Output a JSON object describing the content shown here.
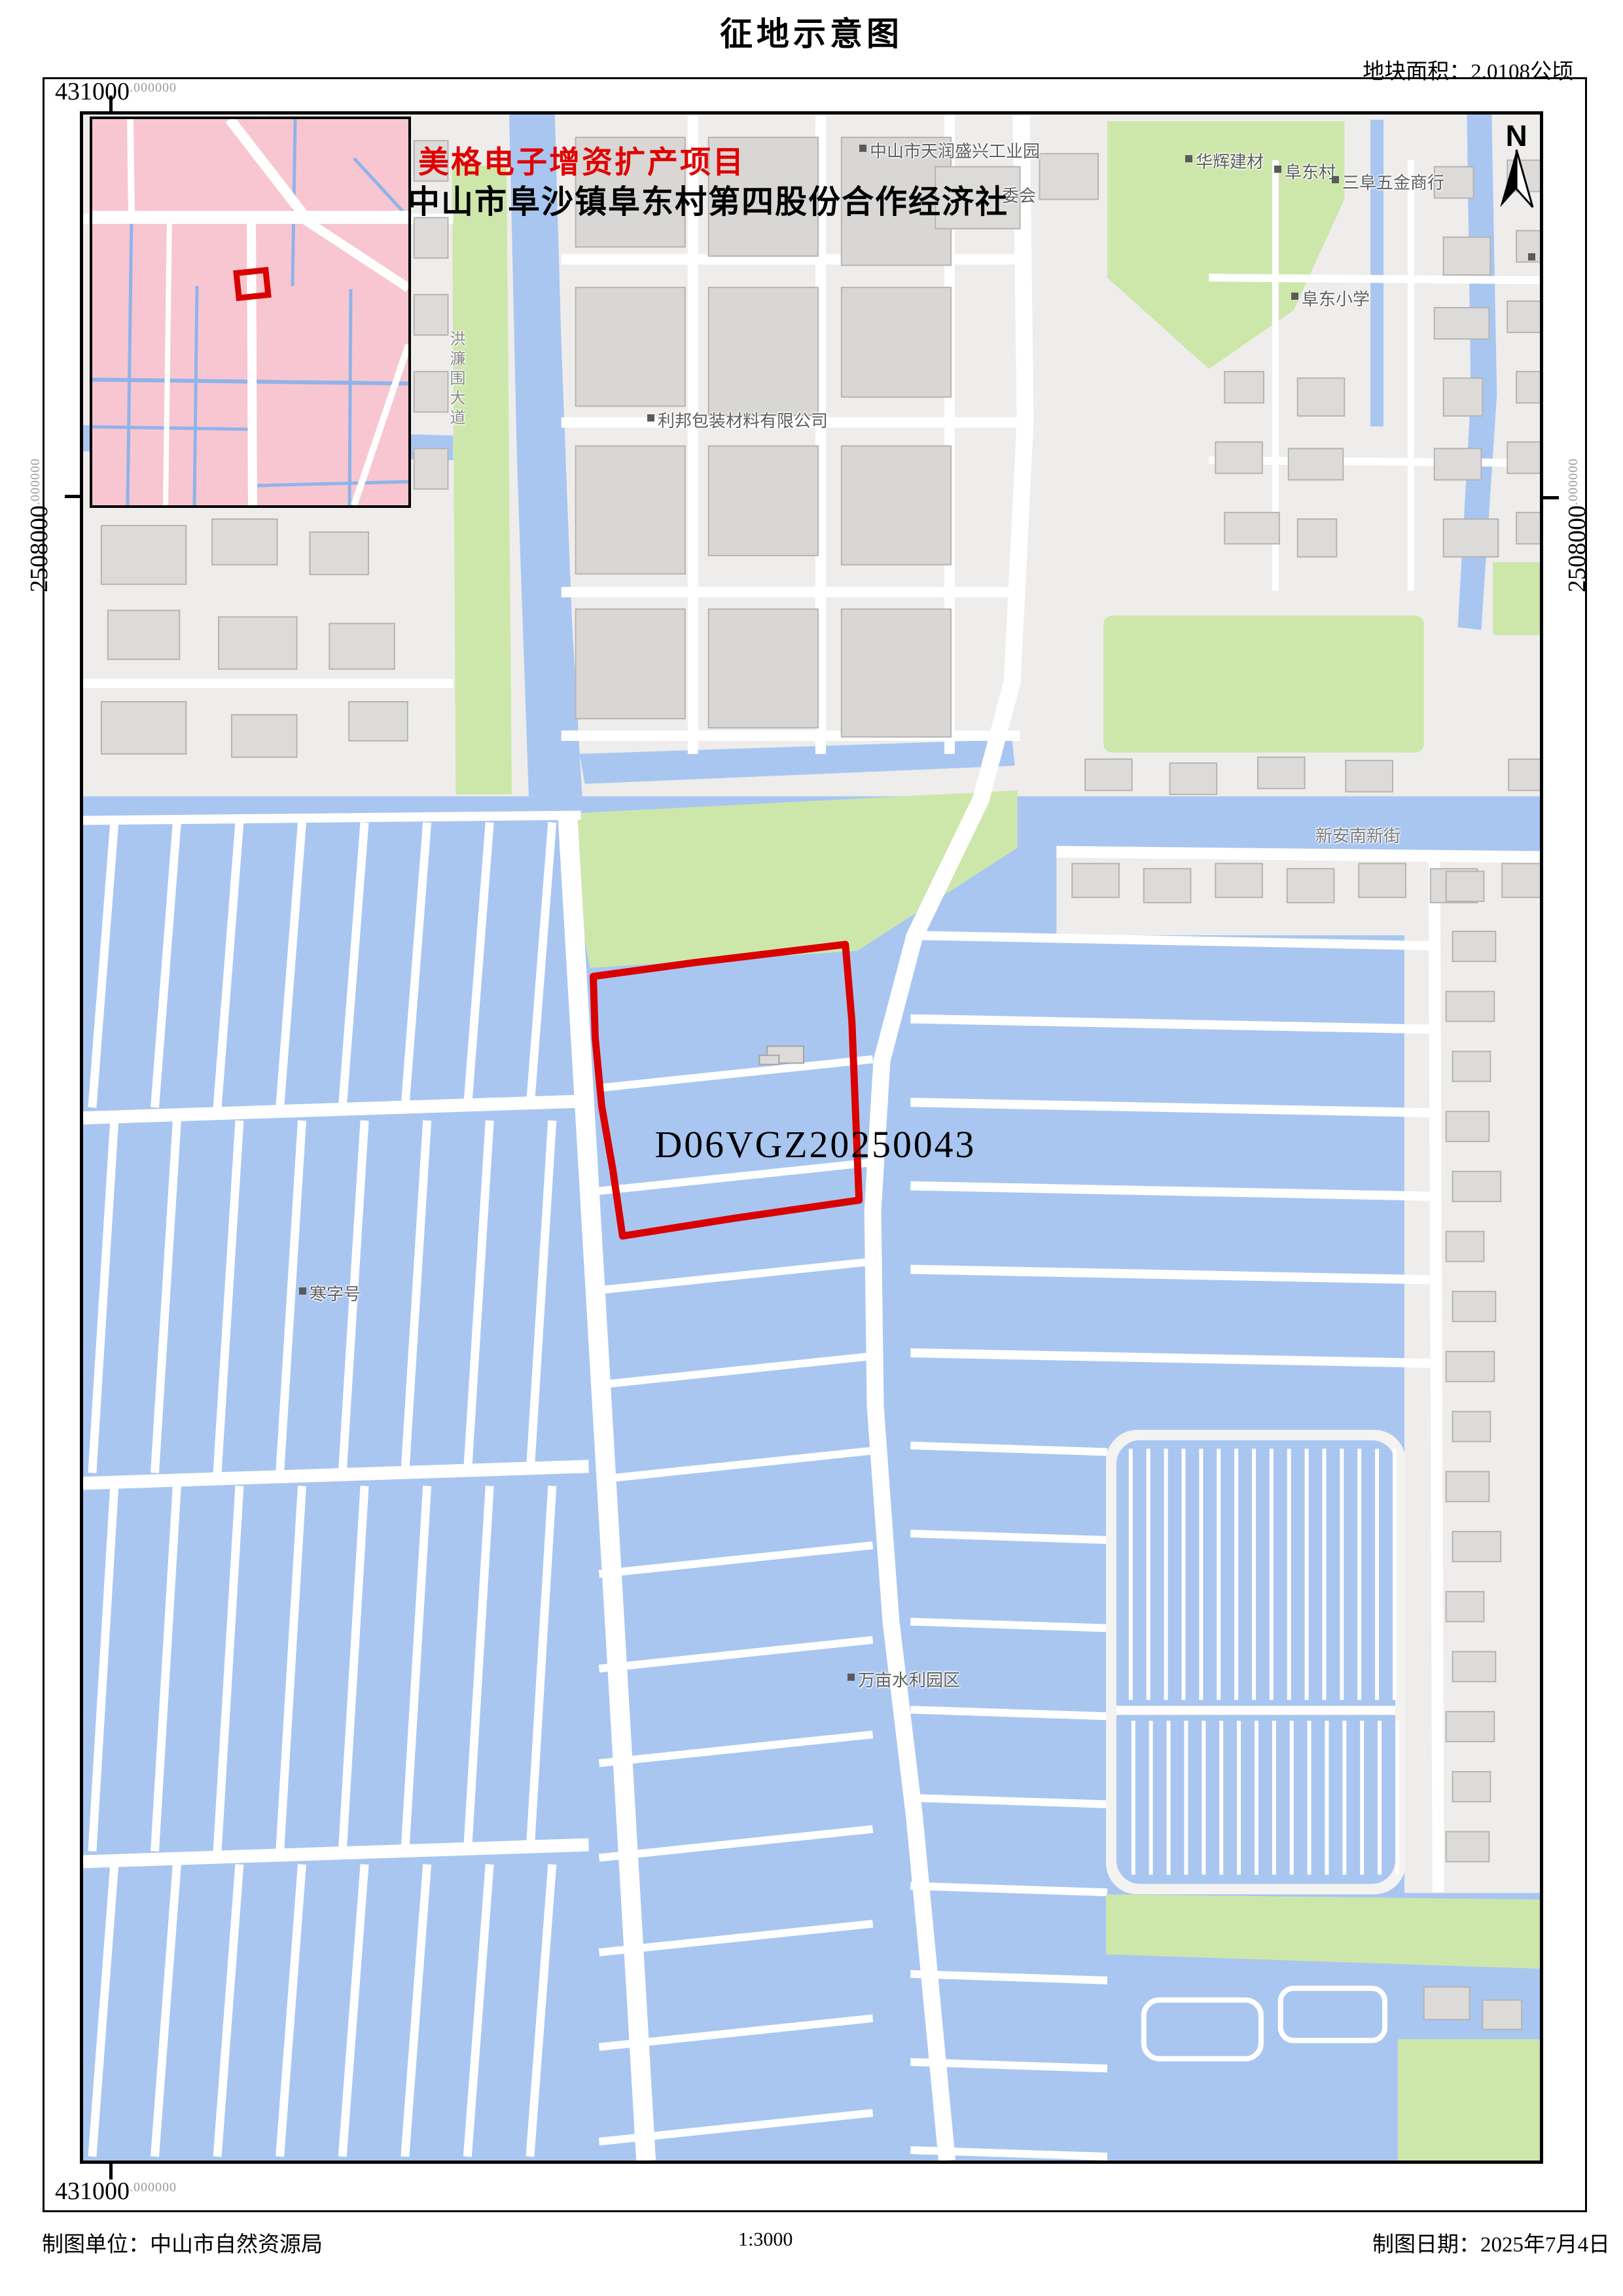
{
  "header": {
    "title": "征地示意图",
    "area_label": "地块面积：2.0108公顷"
  },
  "overlay": {
    "project_name": "美格电子增资扩产项目",
    "owner_name": "中山市阜沙镇阜东村第四股份合作经济社"
  },
  "parcel": {
    "code": "D06VGZ20250043"
  },
  "compass": {
    "north_label": "N"
  },
  "coordinates": {
    "easting": "431000",
    "northing": "2508000",
    "decimal_suffix": ".000000"
  },
  "map_labels": [
    {
      "id": "tianrun",
      "text": "中山市天润盛兴工业园"
    },
    {
      "id": "huahui",
      "text": "华辉建材"
    },
    {
      "id": "fudongcun",
      "text": "阜东村"
    },
    {
      "id": "sanfu",
      "text": "三阜五金商行"
    },
    {
      "id": "school",
      "text": "阜东小学"
    },
    {
      "id": "libang",
      "text": "利邦包装材料有限公司"
    },
    {
      "id": "weihui",
      "text": "委会"
    },
    {
      "id": "xinan",
      "text": "新安南新街"
    },
    {
      "id": "hanzihao",
      "text": "寒字号"
    },
    {
      "id": "wanmu",
      "text": "万亩水利园区"
    },
    {
      "id": "fu_partial",
      "text": "阜"
    },
    {
      "id": "honglianwei",
      "text": "洪濂围大道"
    }
  ],
  "footer": {
    "agency": "制图单位：中山市自然资源局",
    "scale": "1:3000",
    "date": "制图日期：2025年7月4日"
  },
  "colors": {
    "parcel_red": "#d90000",
    "water": "#a9c6f1",
    "green": "#cde7ab",
    "urban": "#eeedeb",
    "building": "#dcdbd9",
    "building_dark": "#d8d7d5",
    "building_stroke": "#b5b4b2",
    "road_white": "#ffffff",
    "dike_white": "#f4f3f1",
    "inset_pink": "#f8c6d0",
    "inset_canal": "#8fb3ea",
    "label_gray": "#5f5f5f"
  }
}
